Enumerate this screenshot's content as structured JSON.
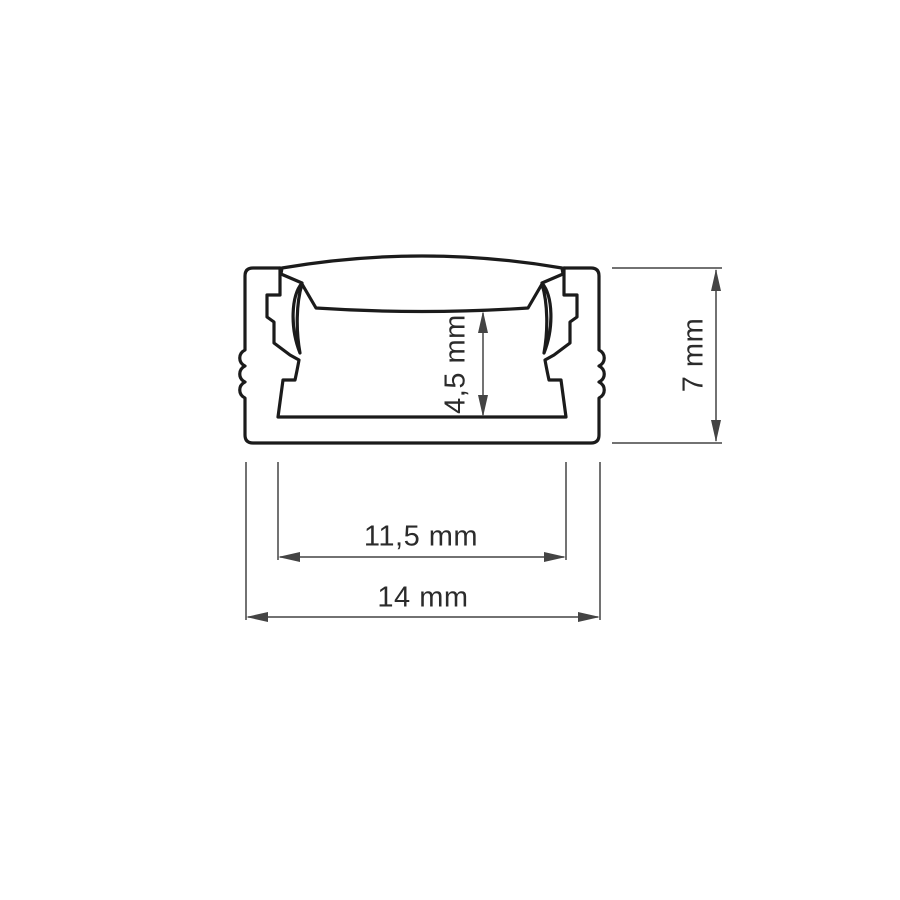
{
  "page": {
    "background": "#ffffff",
    "title": "LED aluminium profile cross-section technical drawing"
  },
  "drawing": {
    "type": "technical-cross-section-diagram",
    "subject": "Surface-mount LED aluminium profile channel with clip-on arched cover",
    "colors": {
      "profile_line": "#1b1b1b",
      "dimension_line": "#444444",
      "label_text": "#2b2b2b",
      "background": "#ffffff"
    },
    "labels": {
      "inner_height": "4,5 mm",
      "outer_height": "7 mm",
      "inner_width": "11,5 mm",
      "outer_width": "14 mm"
    }
  }
}
